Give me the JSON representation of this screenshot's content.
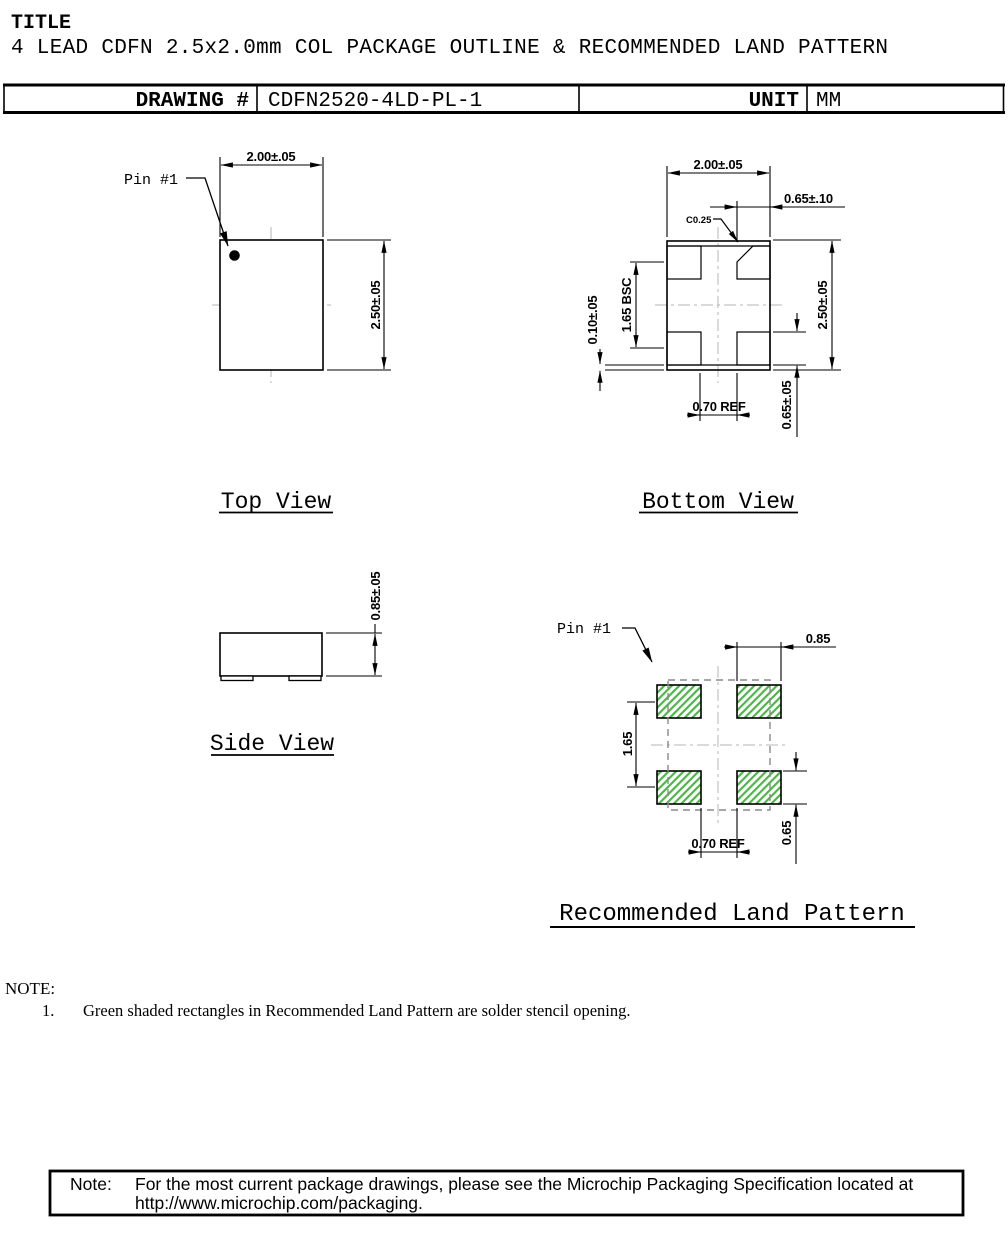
{
  "header": {
    "label": "TITLE",
    "title": "4 LEAD CDFN 2.5x2.0mm COL PACKAGE OUTLINE & RECOMMENDED LAND PATTERN"
  },
  "info_table": {
    "drawing_label": "DRAWING #",
    "drawing_number": "CDFN2520-4LD-PL-1",
    "unit_label": "UNIT",
    "unit_value": "MM"
  },
  "views": {
    "top": {
      "title": "Top View",
      "pin1_label": "Pin #1",
      "dim_width": "2.00±.05",
      "dim_height": "2.50±.05"
    },
    "bottom": {
      "title": "Bottom View",
      "dim_width": "2.00±.05",
      "dim_height": "2.50±.05",
      "dim_terminal_width": "0.65±.10",
      "dim_chamfer": "C0.25",
      "dim_pitch": "1.65 BSC",
      "dim_pullback": "0.10±.05",
      "dim_terminal_length": "0.65±.05",
      "dim_gap": "0.70 REF"
    },
    "side": {
      "title": "Side View",
      "dim_thickness": "0.85±.05"
    },
    "land": {
      "title": "Recommended Land Pattern",
      "pin1_label": "Pin #1",
      "dim_pad_width": "0.85",
      "dim_pitch": "1.65",
      "dim_pad_length": "0.65",
      "dim_gap": "0.70 REF"
    }
  },
  "notes": {
    "heading": "NOTE:",
    "item_number": "1.",
    "item_text": "Green shaded rectangles in Recommended Land Pattern are solder stencil opening."
  },
  "footer_note": {
    "label": "Note:",
    "line1": "For the most current package drawings, please see the Microchip Packaging Specification located at",
    "line2": "http://www.microchip.com/packaging."
  },
  "colors": {
    "stencil_green": "#4db848",
    "centerline_gray": "#b4b4b4",
    "body_dash_gray": "#8a8a8a",
    "outline_black": "#000000"
  }
}
